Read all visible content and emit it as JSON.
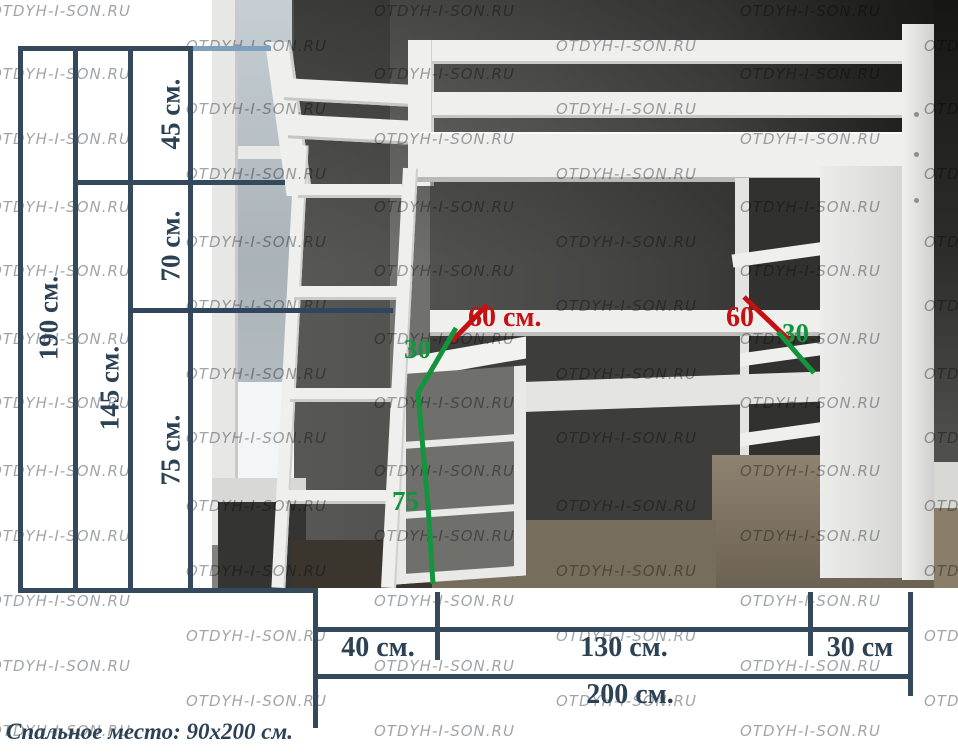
{
  "watermark": {
    "text": "OTDYH-I-SON.RU",
    "cols": [
      -10,
      186,
      374,
      556,
      740,
      924
    ],
    "rows": [
      2,
      65,
      130,
      198,
      262,
      330,
      394,
      462,
      527,
      592,
      657,
      722
    ],
    "odd_offset": 35
  },
  "colors": {
    "dimension_line": "#35495c",
    "dimension_line_light": "#7fa0bc",
    "dimension_text": "#2c4154",
    "red_annotation": "#c51111",
    "green_annotation": "#13953e"
  },
  "height_dims": {
    "total": "190 см.",
    "from_shelf": "145 см.",
    "seg_top": "45 см.",
    "seg_mid": "70 см.",
    "seg_bottom": "75 см."
  },
  "depth_annotations": {
    "desk_depth": "60 см.",
    "dresser_depth": "30",
    "dresser_height": "75",
    "shelf_depth_60": "60",
    "shelf_depth_30": "30"
  },
  "width_dims": {
    "dresser": "40 см.",
    "desk": "130 см.",
    "shelf": "30 см",
    "total": "200 см."
  },
  "caption": {
    "text": "Спальное место: 90x200 см."
  }
}
